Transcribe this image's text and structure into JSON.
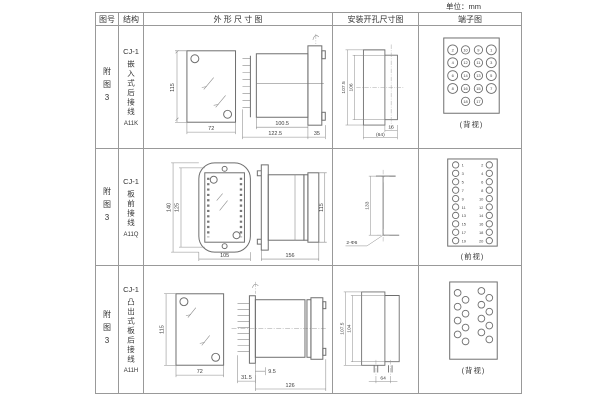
{
  "unit_label": "单位：mm",
  "headers": {
    "fig_no": "图号",
    "structure": "结构",
    "outline": "外 形 尺 寸 图",
    "install": "安装开孔尺寸图",
    "terminal": "端子图"
  },
  "rows": [
    {
      "fig_no": "附图3",
      "model": "CJ-1",
      "desc": "嵌入式后接线",
      "code": "A11K",
      "outline_dims": {
        "height": "115",
        "width": "72",
        "body": "100.5",
        "overall": "122.5",
        "flange": "35"
      },
      "install_dims": {
        "outer": "107.5",
        "inner": "106",
        "slot": "16",
        "width": "(64)"
      },
      "terminal": {
        "caption": "(背视)",
        "pins": [
          {
            "x": 28,
            "y": 24,
            "r": 5,
            "n": "2"
          },
          {
            "x": 41,
            "y": 24,
            "r": 4.2,
            "n": "10"
          },
          {
            "x": 54,
            "y": 24,
            "r": 4.2,
            "n": "9"
          },
          {
            "x": 67,
            "y": 24,
            "r": 5,
            "n": "1"
          },
          {
            "x": 28,
            "y": 37,
            "r": 5,
            "n": "4"
          },
          {
            "x": 41,
            "y": 37,
            "r": 4.2,
            "n": "12"
          },
          {
            "x": 54,
            "y": 37,
            "r": 4.2,
            "n": "11"
          },
          {
            "x": 67,
            "y": 37,
            "r": 5,
            "n": "3"
          },
          {
            "x": 28,
            "y": 50,
            "r": 5,
            "n": "6"
          },
          {
            "x": 41,
            "y": 50,
            "r": 4.2,
            "n": "14"
          },
          {
            "x": 54,
            "y": 50,
            "r": 4.2,
            "n": "13"
          },
          {
            "x": 67,
            "y": 50,
            "r": 5,
            "n": "5"
          },
          {
            "x": 28,
            "y": 63,
            "r": 5,
            "n": "8"
          },
          {
            "x": 41,
            "y": 63,
            "r": 4.2,
            "n": "16"
          },
          {
            "x": 54,
            "y": 63,
            "r": 4.2,
            "n": "15"
          },
          {
            "x": 67,
            "y": 63,
            "r": 5,
            "n": "7"
          },
          {
            "x": 41,
            "y": 76,
            "r": 4.2,
            "n": "18"
          },
          {
            "x": 54,
            "y": 76,
            "r": 4.2,
            "n": "17"
          }
        ]
      }
    },
    {
      "fig_no": "附图3",
      "model": "CJ-1",
      "desc": "板前接线",
      "code": "A11Q",
      "outline_dims": {
        "outer_h": "140",
        "inner_h": "125",
        "width": "105",
        "length": "156",
        "height": "115"
      },
      "install_dims": {
        "spacing": "133",
        "holes": "2-Φ6"
      },
      "terminal": {
        "caption": "(前视)",
        "pins": [
          {
            "x": 31,
            "y": 16,
            "r": 3.2,
            "n": "1",
            "nx": 37,
            "ny": 17.8,
            "anchor": "start"
          },
          {
            "x": 65,
            "y": 16,
            "r": 3.2,
            "n": "2",
            "nx": 59,
            "ny": 17.8,
            "anchor": "end"
          },
          {
            "x": 31,
            "y": 24.5,
            "r": 3.2,
            "n": "3",
            "nx": 37,
            "ny": 26.3,
            "anchor": "start"
          },
          {
            "x": 65,
            "y": 24.5,
            "r": 3.2,
            "n": "4",
            "nx": 59,
            "ny": 26.3,
            "anchor": "end"
          },
          {
            "x": 31,
            "y": 33,
            "r": 3.2,
            "n": "5",
            "nx": 37,
            "ny": 34.8,
            "anchor": "start"
          },
          {
            "x": 65,
            "y": 33,
            "r": 3.2,
            "n": "6",
            "nx": 59,
            "ny": 34.8,
            "anchor": "end"
          },
          {
            "x": 31,
            "y": 41.5,
            "r": 3.2,
            "n": "7",
            "nx": 37,
            "ny": 43.3,
            "anchor": "start"
          },
          {
            "x": 65,
            "y": 41.5,
            "r": 3.2,
            "n": "8",
            "nx": 59,
            "ny": 43.3,
            "anchor": "end"
          },
          {
            "x": 31,
            "y": 50,
            "r": 3.2,
            "n": "9",
            "nx": 37,
            "ny": 51.8,
            "anchor": "start"
          },
          {
            "x": 65,
            "y": 50,
            "r": 3.2,
            "n": "10",
            "nx": 59,
            "ny": 51.8,
            "anchor": "end"
          },
          {
            "x": 31,
            "y": 58.5,
            "r": 3.2,
            "n": "11",
            "nx": 37,
            "ny": 60.3,
            "anchor": "start"
          },
          {
            "x": 65,
            "y": 58.5,
            "r": 3.2,
            "n": "12",
            "nx": 59,
            "ny": 60.3,
            "anchor": "end"
          },
          {
            "x": 31,
            "y": 67,
            "r": 3.2,
            "n": "13",
            "nx": 37,
            "ny": 68.8,
            "anchor": "start"
          },
          {
            "x": 65,
            "y": 67,
            "r": 3.2,
            "n": "14",
            "nx": 59,
            "ny": 68.8,
            "anchor": "end"
          },
          {
            "x": 31,
            "y": 75.5,
            "r": 3.2,
            "n": "15",
            "nx": 37,
            "ny": 77.3,
            "anchor": "start"
          },
          {
            "x": 65,
            "y": 75.5,
            "r": 3.2,
            "n": "16",
            "nx": 59,
            "ny": 77.3,
            "anchor": "end"
          },
          {
            "x": 31,
            "y": 84,
            "r": 3.2,
            "n": "17",
            "nx": 37,
            "ny": 85.8,
            "anchor": "start"
          },
          {
            "x": 65,
            "y": 84,
            "r": 3.2,
            "n": "18",
            "nx": 59,
            "ny": 85.8,
            "anchor": "end"
          },
          {
            "x": 31,
            "y": 92.5,
            "r": 3.2,
            "n": "19",
            "nx": 37,
            "ny": 94.3,
            "anchor": "start"
          },
          {
            "x": 65,
            "y": 92.5,
            "r": 3.2,
            "n": "20",
            "nx": 59,
            "ny": 94.3,
            "anchor": "end"
          }
        ]
      }
    },
    {
      "fig_no": "附图3",
      "model": "CJ-1",
      "desc": "凸出式板后接线",
      "code": "A11H",
      "outline_dims": {
        "height": "115",
        "width": "72",
        "plate": "31.5",
        "offset": "9.5",
        "length": "126"
      },
      "install_dims": {
        "outer": "107.5",
        "inner": "104",
        "width": "64"
      },
      "terminal": {
        "caption": "(背视)",
        "pins": [
          {
            "x": 33,
            "y": 27,
            "r": 3.4
          },
          {
            "x": 41,
            "y": 34,
            "r": 3.4
          },
          {
            "x": 33,
            "y": 41,
            "r": 3.4
          },
          {
            "x": 41,
            "y": 48,
            "r": 3.4
          },
          {
            "x": 33,
            "y": 55,
            "r": 3.4
          },
          {
            "x": 41,
            "y": 62,
            "r": 3.4
          },
          {
            "x": 33,
            "y": 69,
            "r": 3.4
          },
          {
            "x": 41,
            "y": 76,
            "r": 3.4
          },
          {
            "x": 57,
            "y": 25,
            "r": 3.4
          },
          {
            "x": 65,
            "y": 32,
            "r": 3.4
          },
          {
            "x": 57,
            "y": 39,
            "r": 3.4
          },
          {
            "x": 65,
            "y": 46,
            "r": 3.4
          },
          {
            "x": 57,
            "y": 53,
            "r": 3.4
          },
          {
            "x": 65,
            "y": 60,
            "r": 3.4
          },
          {
            "x": 57,
            "y": 67,
            "r": 3.4
          },
          {
            "x": 65,
            "y": 74,
            "r": 3.4
          }
        ]
      }
    }
  ]
}
